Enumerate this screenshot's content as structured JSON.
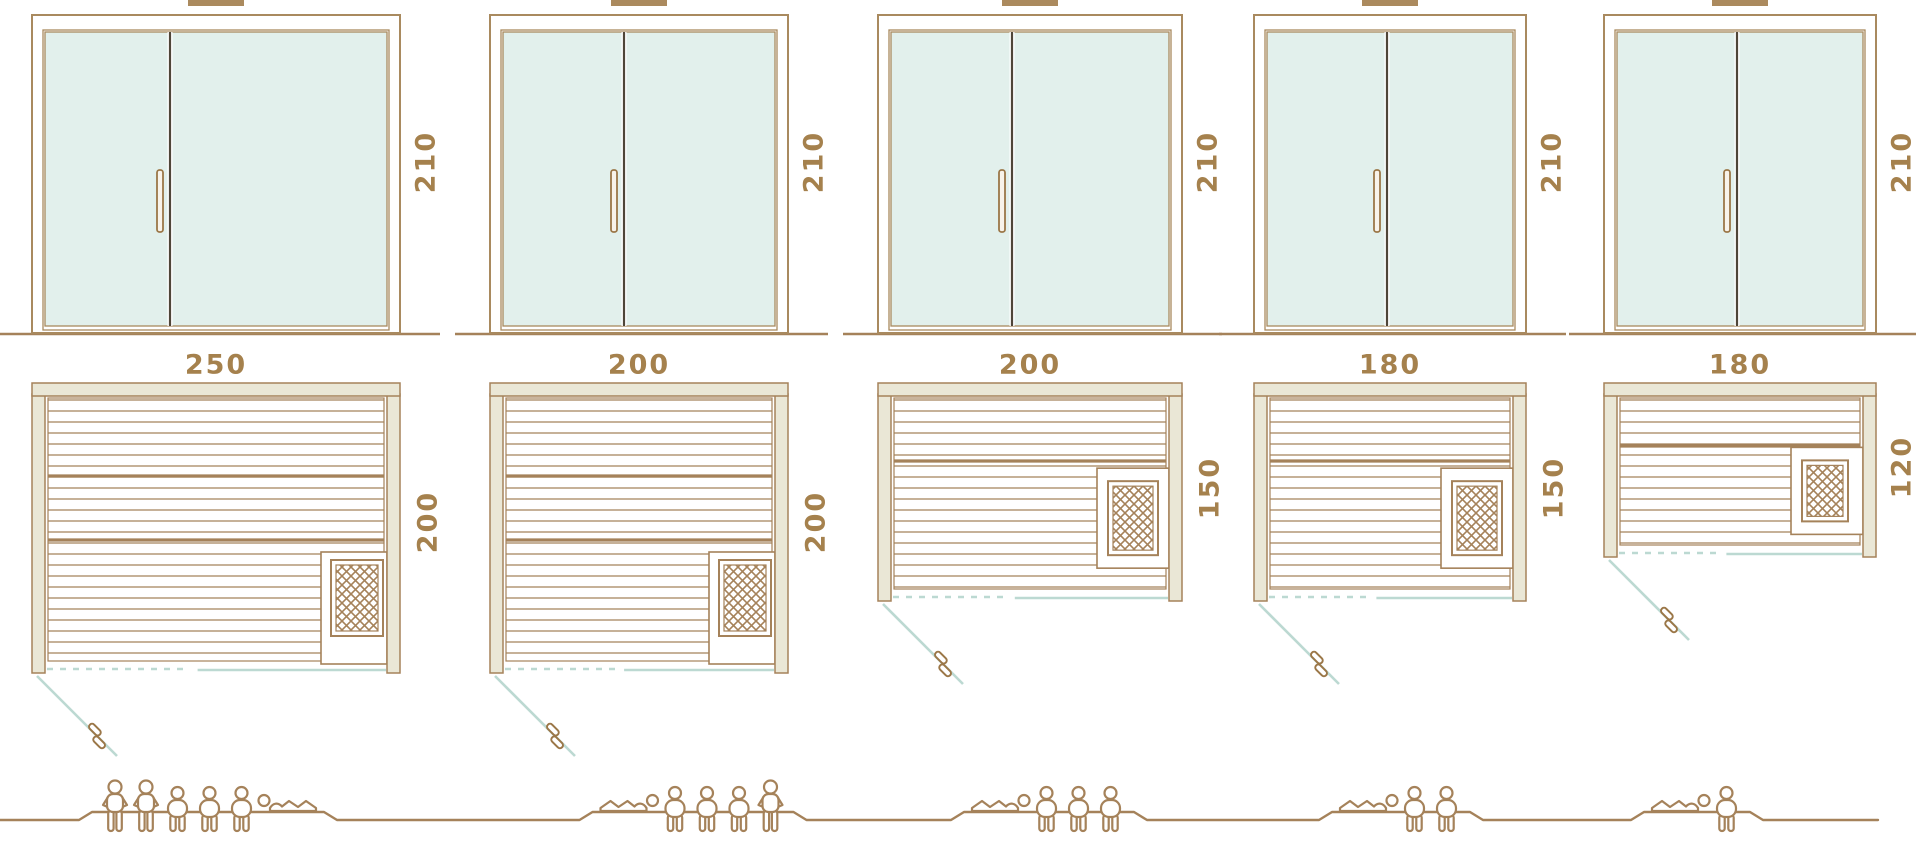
{
  "diagram_title": "sauna-cabin-size-comparison",
  "colors": {
    "line_brown": "#a5825a",
    "frame_brown": "#a98a5f",
    "door_divider_dark": "#4f4639",
    "glass_mint": "#e2f0ec",
    "frame_beige_fill": "#eae7d6",
    "door_teal": "#bcd9d2",
    "label_brown": "#a5814d",
    "handle_brown": "#9b7748",
    "top_marker_tan": "#ab8a5e",
    "background": "#ffffff"
  },
  "units": [
    {
      "door_height_label": "210",
      "width_label": "250",
      "depth_label": "200",
      "door_height_cm": 210,
      "width_cm": 250,
      "depth_cm": 200,
      "heater_position": "bottom-right",
      "capacity": 6,
      "figures": [
        "standing",
        "standing",
        "sitting",
        "sitting",
        "sitting",
        "lying-head-left"
      ]
    },
    {
      "door_height_label": "210",
      "width_label": "200",
      "depth_label": "200",
      "door_height_cm": 210,
      "width_cm": 200,
      "depth_cm": 200,
      "heater_position": "bottom-right",
      "capacity": 5,
      "figures": [
        "lying-head-right",
        "sitting",
        "sitting",
        "sitting",
        "standing"
      ]
    },
    {
      "door_height_label": "210",
      "width_label": "200",
      "depth_label": "150",
      "door_height_cm": 210,
      "width_cm": 200,
      "depth_cm": 150,
      "heater_position": "middle-right",
      "capacity": 4,
      "figures": [
        "lying-head-right",
        "sitting",
        "sitting",
        "sitting"
      ]
    },
    {
      "door_height_label": "210",
      "width_label": "180",
      "depth_label": "150",
      "door_height_cm": 210,
      "width_cm": 180,
      "depth_cm": 150,
      "heater_position": "middle-right",
      "capacity": 3,
      "figures": [
        "lying-head-right",
        "sitting",
        "sitting"
      ]
    },
    {
      "door_height_label": "210",
      "width_label": "180",
      "depth_label": "120",
      "door_height_cm": 210,
      "width_cm": 180,
      "depth_cm": 120,
      "heater_position": "middle-right",
      "capacity": 2,
      "figures": [
        "lying-head-right",
        "sitting"
      ]
    }
  ]
}
